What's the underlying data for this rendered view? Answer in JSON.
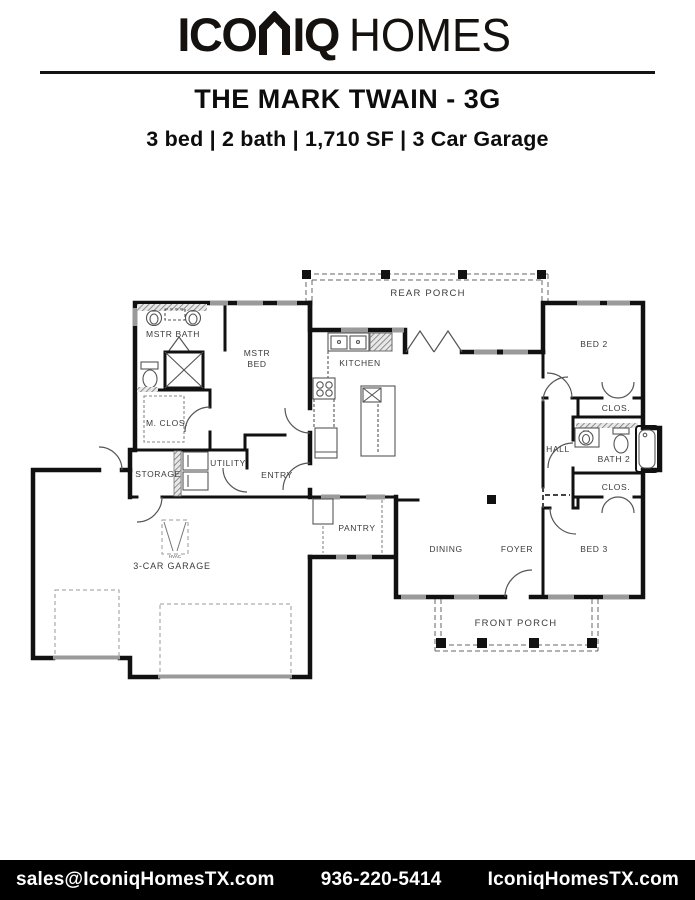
{
  "header": {
    "brand_prefix": "ICO",
    "brand_suffix": "IQ",
    "brand_secondary": "HOMES",
    "plan_title": "THE MARK TWAIN - 3G",
    "plan_specs": "3 bed | 2 bath | 1,710 SF | 3 Car Garage"
  },
  "plan": {
    "labels": {
      "rear_porch": "REAR PORCH",
      "mstr_bath": "MSTR BATH",
      "mstr_bed_line1": "MSTR",
      "mstr_bed_line2": "BED",
      "kitchen": "KITCHEN",
      "bed2": "BED 2",
      "m_clos": "M. CLOS.",
      "clos1": "CLOS.",
      "hall": "HALL",
      "bath2": "BATH 2",
      "storage": "STORAGE",
      "utility": "UTILITY",
      "entry": "ENTRY",
      "clos2": "CLOS.",
      "pantry": "PANTRY",
      "dining": "DINING",
      "foyer": "FOYER",
      "bed3": "BED 3",
      "garage": "3-CAR GARAGE",
      "hvac": "HVAC",
      "front_porch": "FRONT PORCH"
    }
  },
  "footer": {
    "email": "sales@IconiqHomesTX.com",
    "phone": "936-220-5414",
    "website": "IconiqHomesTX.com"
  },
  "colors": {
    "wall": "#111111",
    "window": "#9a9a9a",
    "fixture": "#555555",
    "dashed": "#777777",
    "label": "#3b3b3b",
    "footer_bg": "#000000",
    "footer_text": "#ffffff"
  }
}
